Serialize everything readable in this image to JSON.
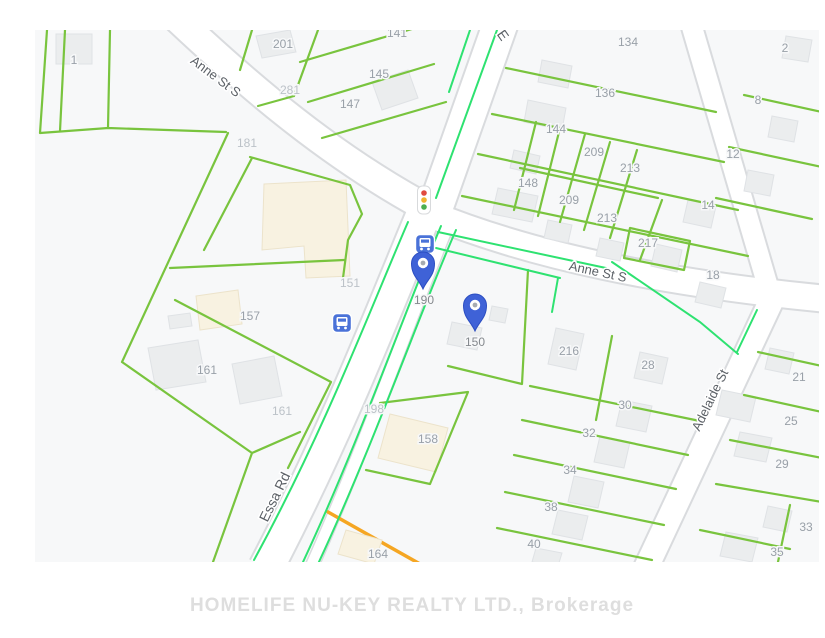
{
  "map": {
    "watermark": "HOMELIFE NU-KEY REALTY LTD., Brokerage",
    "colors": {
      "map_bg": "#f7f8f9",
      "road_fill": "#ffffff",
      "road_casing": "#d9dbde",
      "parcel_line": "#79c43e",
      "overlay_line": "#2ee271",
      "building_gray": "#ebedee",
      "building_beige": "#f8f2e1",
      "lot_label": "#99a0a8",
      "lot_label_faint": "#bcc2c8",
      "street_label": "#5c6167",
      "pin_blue": "#3f62d7",
      "transit_blue": "#4a72d8",
      "orange_segment": "#f5a623",
      "watermark_color": "#dedede"
    },
    "streets": [
      {
        "name": "Anne St S",
        "x": 213,
        "y": 80,
        "rot": 37,
        "big": false
      },
      {
        "name": "E",
        "x": 499,
        "y": 38,
        "rot": 55,
        "big": true
      },
      {
        "name": "Anne St S",
        "x": 597,
        "y": 276,
        "rot": 12,
        "big": false
      },
      {
        "name": "Essa Rd",
        "x": 279,
        "y": 499,
        "rot": -64,
        "big": true
      },
      {
        "name": "Adelaide St",
        "x": 714,
        "y": 402,
        "rot": -64,
        "big": false
      }
    ],
    "lots": [
      {
        "t": "1",
        "x": 74,
        "y": 64,
        "f": false
      },
      {
        "t": "201",
        "x": 283,
        "y": 48,
        "f": false
      },
      {
        "t": "281",
        "x": 290,
        "y": 94,
        "f": true
      },
      {
        "t": "141",
        "x": 397,
        "y": 37,
        "f": false
      },
      {
        "t": "145",
        "x": 379,
        "y": 78,
        "f": false
      },
      {
        "t": "147",
        "x": 350,
        "y": 108,
        "f": false
      },
      {
        "t": "181",
        "x": 247,
        "y": 147,
        "f": true
      },
      {
        "t": "134",
        "x": 628,
        "y": 46,
        "f": false
      },
      {
        "t": "2",
        "x": 785,
        "y": 52,
        "f": false
      },
      {
        "t": "136",
        "x": 605,
        "y": 97,
        "f": false
      },
      {
        "t": "8",
        "x": 758,
        "y": 104,
        "f": false
      },
      {
        "t": "144",
        "x": 556,
        "y": 133,
        "f": false
      },
      {
        "t": "209",
        "x": 594,
        "y": 156,
        "f": false
      },
      {
        "t": "213",
        "x": 630,
        "y": 172,
        "f": false
      },
      {
        "t": "12",
        "x": 733,
        "y": 158,
        "f": false
      },
      {
        "t": "148",
        "x": 528,
        "y": 187,
        "f": false
      },
      {
        "t": "209",
        "x": 569,
        "y": 204,
        "f": false
      },
      {
        "t": "14",
        "x": 708,
        "y": 209,
        "f": false
      },
      {
        "t": "213",
        "x": 607,
        "y": 222,
        "f": false
      },
      {
        "t": "217",
        "x": 648,
        "y": 247,
        "f": false
      },
      {
        "t": "18",
        "x": 713,
        "y": 279,
        "f": false
      },
      {
        "t": "151",
        "x": 350,
        "y": 287,
        "f": true
      },
      {
        "t": "157",
        "x": 250,
        "y": 320,
        "f": false
      },
      {
        "t": "161",
        "x": 207,
        "y": 374,
        "f": false
      },
      {
        "t": "161",
        "x": 282,
        "y": 415,
        "f": true
      },
      {
        "t": "216",
        "x": 569,
        "y": 355,
        "f": false
      },
      {
        "t": "28",
        "x": 648,
        "y": 369,
        "f": false
      },
      {
        "t": "30",
        "x": 625,
        "y": 409,
        "f": false
      },
      {
        "t": "198",
        "x": 374,
        "y": 413,
        "f": true
      },
      {
        "t": "158",
        "x": 428,
        "y": 443,
        "f": false
      },
      {
        "t": "32",
        "x": 589,
        "y": 437,
        "f": false
      },
      {
        "t": "34",
        "x": 570,
        "y": 474,
        "f": false
      },
      {
        "t": "38",
        "x": 551,
        "y": 511,
        "f": false
      },
      {
        "t": "40",
        "x": 534,
        "y": 548,
        "f": false
      },
      {
        "t": "164",
        "x": 378,
        "y": 558,
        "f": false
      },
      {
        "t": "21",
        "x": 799,
        "y": 381,
        "f": false
      },
      {
        "t": "25",
        "x": 791,
        "y": 425,
        "f": false
      },
      {
        "t": "29",
        "x": 782,
        "y": 468,
        "f": false
      },
      {
        "t": "33",
        "x": 806,
        "y": 531,
        "f": false
      },
      {
        "t": "35",
        "x": 777,
        "y": 556,
        "f": false
      }
    ],
    "pins": [
      {
        "label": "190",
        "tip_x": 423,
        "tip_y": 289,
        "label_x": 424,
        "label_y": 304
      },
      {
        "label": "150",
        "tip_x": 475,
        "tip_y": 331,
        "label_x": 475,
        "label_y": 346
      }
    ],
    "icons": [
      {
        "name": "traffic-light-icon",
        "x": 424,
        "y": 200,
        "interactable": false
      },
      {
        "name": "bus-stop-icon",
        "x": 425,
        "y": 244,
        "interactable": true
      },
      {
        "name": "bus-stop-icon",
        "x": 342,
        "y": 323,
        "interactable": true
      }
    ]
  }
}
